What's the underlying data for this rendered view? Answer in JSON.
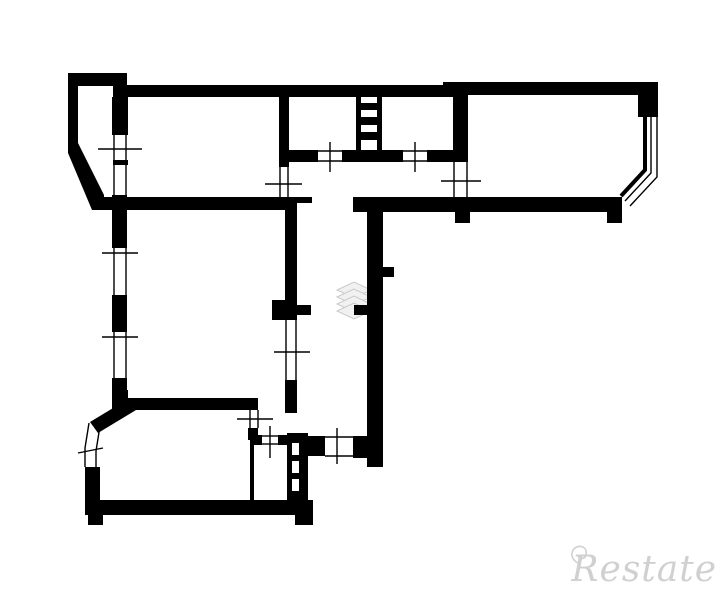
{
  "watermark": {
    "brand": "Restate",
    "text_color": "#c8c8c8",
    "logo_icon": "layers-watermark-icon",
    "swirl_icon": "swirl-icon",
    "logo_fill": "#f1f1f1",
    "logo_stroke": "#c9c9c9"
  },
  "floorplan": {
    "canvas": {
      "width": 725,
      "height": 598
    },
    "background": "#ffffff",
    "wall_color": "#000000",
    "thin_stroke": 1.4,
    "glazing_stroke": 4,
    "walls": [
      [
        68,
        73,
        59,
        13
      ],
      [
        68,
        73,
        10,
        72
      ],
      [
        113,
        85,
        347,
        12
      ],
      [
        443,
        82,
        215,
        13
      ],
      [
        638,
        82,
        20,
        35
      ],
      [
        112,
        97,
        16,
        38
      ],
      [
        113,
        160,
        15,
        5
      ],
      [
        112,
        195,
        15,
        53
      ],
      [
        279,
        97,
        10,
        70
      ],
      [
        356,
        97,
        5,
        55
      ],
      [
        377,
        97,
        5,
        55
      ],
      [
        361,
        103,
        16,
        7
      ],
      [
        361,
        117,
        16,
        8
      ],
      [
        361,
        132,
        16,
        8
      ],
      [
        453,
        95,
        15,
        67
      ],
      [
        285,
        150,
        33,
        12
      ],
      [
        342,
        150,
        61,
        12
      ],
      [
        427,
        150,
        26,
        12
      ],
      [
        92,
        197,
        205,
        13
      ],
      [
        297,
        197,
        15,
        6
      ],
      [
        353,
        197,
        269,
        15
      ],
      [
        455,
        212,
        15,
        11
      ],
      [
        607,
        212,
        15,
        11
      ],
      [
        112,
        295,
        15,
        37
      ],
      [
        112,
        378,
        15,
        32
      ],
      [
        285,
        210,
        12,
        90
      ],
      [
        272,
        300,
        25,
        20
      ],
      [
        297,
        305,
        14,
        10
      ],
      [
        285,
        380,
        12,
        33
      ],
      [
        367,
        200,
        16,
        267
      ],
      [
        383,
        267,
        11,
        10
      ],
      [
        354,
        305,
        13,
        10
      ],
      [
        305,
        436,
        20,
        20
      ],
      [
        353,
        436,
        14,
        22
      ],
      [
        112,
        390,
        16,
        10
      ],
      [
        112,
        398,
        146,
        12
      ],
      [
        85,
        467,
        15,
        48
      ],
      [
        85,
        500,
        228,
        15
      ],
      [
        88,
        515,
        15,
        10
      ],
      [
        295,
        515,
        18,
        10
      ],
      [
        248,
        428,
        10,
        12
      ],
      [
        250,
        435,
        12,
        10
      ],
      [
        278,
        435,
        10,
        10
      ],
      [
        250,
        443,
        4,
        60
      ],
      [
        287,
        433,
        21,
        82
      ]
    ],
    "wall_polygons": [
      "68,143 78,143 104,195 104,210 92,210 68,153",
      "90,422 128,399 136,410 98,433"
    ],
    "white_slots": [
      [
        292,
        443,
        7,
        12
      ],
      [
        292,
        461,
        7,
        12
      ],
      [
        292,
        479,
        7,
        12
      ]
    ],
    "glazing_thick_polylines": [
      "645,117 645,170 621,196"
    ],
    "glazing_thin_polylines": [
      "651,117 651,173 625,201",
      "657,117 657,177 630,206",
      "89,423 85,448 85,467",
      "100,426 96,451 96,467"
    ],
    "frame_lines": [
      [
        114,
        135,
        114,
        160
      ],
      [
        126,
        135,
        126,
        160
      ],
      [
        114,
        165,
        114,
        195
      ],
      [
        126,
        165,
        126,
        195
      ],
      [
        114,
        248,
        114,
        295
      ],
      [
        126,
        248,
        126,
        295
      ],
      [
        114,
        332,
        114,
        378
      ],
      [
        126,
        332,
        126,
        378
      ],
      [
        280,
        167,
        280,
        197
      ],
      [
        288,
        167,
        288,
        197
      ],
      [
        454,
        162,
        454,
        197
      ],
      [
        467,
        162,
        467,
        197
      ],
      [
        286,
        320,
        286,
        380
      ],
      [
        296,
        320,
        296,
        380
      ],
      [
        250,
        410,
        250,
        428
      ],
      [
        258,
        410,
        258,
        428
      ],
      [
        318,
        151,
        342,
        151
      ],
      [
        318,
        161,
        342,
        161
      ],
      [
        403,
        151,
        427,
        151
      ],
      [
        403,
        161,
        427,
        161
      ],
      [
        262,
        436,
        278,
        436
      ],
      [
        262,
        444,
        278,
        444
      ],
      [
        325,
        437,
        353,
        437
      ],
      [
        325,
        456,
        353,
        456
      ]
    ],
    "tick_lines": [
      [
        98,
        149,
        142,
        149
      ],
      [
        102,
        253,
        138,
        253
      ],
      [
        102,
        337,
        138,
        337
      ],
      [
        265,
        184,
        302,
        184
      ],
      [
        441,
        181,
        481,
        181
      ],
      [
        274,
        352,
        310,
        352
      ],
      [
        237,
        419,
        273,
        419
      ],
      [
        270,
        426,
        270,
        458
      ],
      [
        337,
        428,
        337,
        464
      ],
      [
        330,
        142,
        330,
        172
      ],
      [
        415,
        142,
        415,
        172
      ],
      [
        78,
        453,
        103,
        448
      ]
    ],
    "logo_layers": {
      "cx": 354,
      "half_w": 17,
      "half_h": 8,
      "cys": [
        290,
        297,
        304,
        311
      ]
    }
  }
}
